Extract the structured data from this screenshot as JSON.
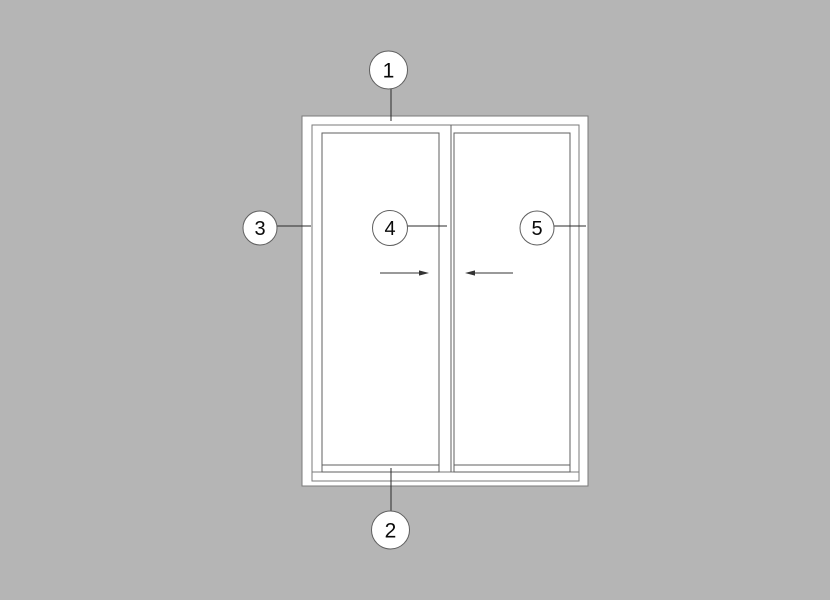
{
  "colors": {
    "background": "#b5b5b5",
    "surface": "#ffffff",
    "line": "#7a7a7a",
    "line-dark": "#5f5f5f",
    "leader": "#2b2b2b",
    "arrow": "#333333",
    "callout-stroke": "#5f5f5f",
    "callout-fill": "#ffffff",
    "callout-text": "#0a0a0a"
  },
  "drawing": {
    "type": "sliding-door-elevation",
    "callouts": [
      {
        "label": "1",
        "points_to": "head-frame-top",
        "leader": "vertical-down"
      },
      {
        "label": "2",
        "points_to": "sill-frame-bottom",
        "leader": "vertical-up"
      },
      {
        "label": "3",
        "points_to": "left-jamb",
        "leader": "horizontal-right"
      },
      {
        "label": "4",
        "points_to": "center-meeting-stile",
        "leader": "horizontal-right"
      },
      {
        "label": "5",
        "points_to": "right-jamb",
        "leader": "horizontal-right"
      }
    ],
    "arrows": [
      {
        "name": "left-panel-slide-direction",
        "direction": "right"
      },
      {
        "name": "right-panel-slide-direction",
        "direction": "left"
      }
    ]
  }
}
